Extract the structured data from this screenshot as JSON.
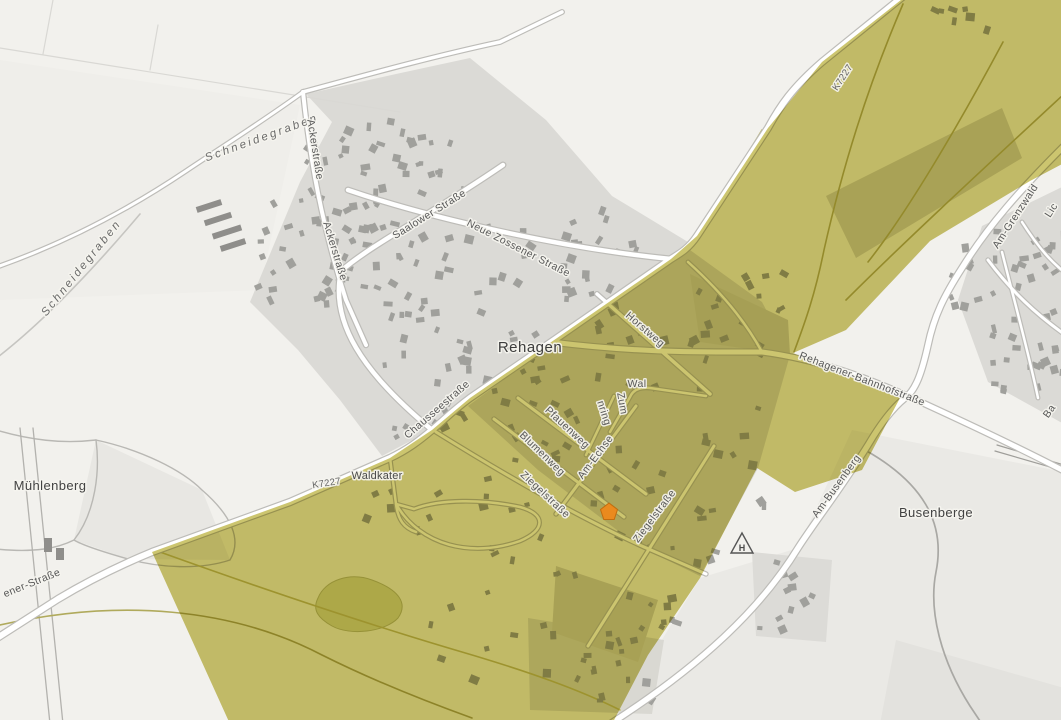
{
  "map": {
    "place_labels": [
      "Rehagen",
      "Mühlenberg",
      "Busenberge",
      "Waldkater"
    ],
    "labels": [
      {
        "text": "Schneidegraben",
        "x": 263,
        "y": 141,
        "rot": -20,
        "cls": "water"
      },
      {
        "text": "Schneidegraben",
        "x": 84,
        "y": 270,
        "rot": -51,
        "cls": "water"
      },
      {
        "text": "Ackerstraße",
        "x": 312,
        "y": 150,
        "rot": 81,
        "cls": "street"
      },
      {
        "text": "Ackerstraße",
        "x": 332,
        "y": 252,
        "rot": 73,
        "cls": "street"
      },
      {
        "text": "Saalower Straße",
        "x": 431,
        "y": 217,
        "rot": -32,
        "cls": "street"
      },
      {
        "text": "Neue Zossener Straße",
        "x": 517,
        "y": 251,
        "rot": 27,
        "cls": "street"
      },
      {
        "text": "Rehagen",
        "x": 530,
        "y": 352,
        "rot": 0,
        "cls": "place"
      },
      {
        "text": "Horstweg",
        "x": 643,
        "y": 332,
        "rot": 41,
        "cls": "street"
      },
      {
        "text": "Chausseestraße",
        "x": 439,
        "y": 412,
        "rot": -41,
        "cls": "street"
      },
      {
        "text": "Rehagener-Bahnhofstraße",
        "x": 861,
        "y": 382,
        "rot": 21,
        "cls": "street"
      },
      {
        "text": "K7227",
        "x": 845,
        "y": 79,
        "rot": -57,
        "cls": "ref"
      },
      {
        "text": "K7227",
        "x": 327,
        "y": 486,
        "rot": -9,
        "cls": "ref"
      },
      {
        "text": "Waldkater",
        "x": 377,
        "y": 479,
        "rot": 0,
        "cls": "locality"
      },
      {
        "text": "ener-Straße",
        "x": 33,
        "y": 586,
        "rot": -22,
        "cls": "street"
      },
      {
        "text": "Mühlenberg",
        "x": 50,
        "y": 490,
        "rot": 0,
        "cls": "place2"
      },
      {
        "text": "Ziegelstraße",
        "x": 543,
        "y": 497,
        "rot": 43,
        "cls": "street"
      },
      {
        "text": "Ziegelstraße",
        "x": 657,
        "y": 518,
        "rot": -53,
        "cls": "street"
      },
      {
        "text": "Blumenweg",
        "x": 540,
        "y": 456,
        "rot": 44,
        "cls": "street"
      },
      {
        "text": "Pfauenweg",
        "x": 565,
        "y": 430,
        "rot": 43,
        "cls": "street"
      },
      {
        "text": "Am-Echse",
        "x": 598,
        "y": 459,
        "rot": -53,
        "cls": "street"
      },
      {
        "text": "nring",
        "x": 601,
        "y": 414,
        "rot": 72,
        "cls": "street"
      },
      {
        "text": "Zum",
        "x": 619,
        "y": 404,
        "rot": 80,
        "cls": "street"
      },
      {
        "text": "Wal",
        "x": 637,
        "y": 387,
        "rot": 0,
        "cls": "street"
      },
      {
        "text": "Am-Busenberg",
        "x": 839,
        "y": 488,
        "rot": -54,
        "cls": "street"
      },
      {
        "text": "Busenberge",
        "x": 936,
        "y": 517,
        "rot": 0,
        "cls": "place2"
      },
      {
        "text": "Am-Grenzwald",
        "x": 1018,
        "y": 218,
        "rot": -57,
        "cls": "street"
      },
      {
        "text": "Lic",
        "x": 1054,
        "y": 212,
        "rot": -57,
        "cls": "street"
      },
      {
        "text": "Ba",
        "x": 1052,
        "y": 413,
        "rot": -55,
        "cls": "street"
      }
    ],
    "marker": {
      "x": 609,
      "y": 512,
      "color": "#ea8a1e",
      "border": "#c26d0e"
    },
    "hunting_stand": {
      "x": 742,
      "y": 545,
      "letter": "H"
    },
    "colors": {
      "overlay_olive": "#ccc56f",
      "field_white": "#f2f1ed",
      "residential_gray": "#dbdad6",
      "building_gray": "#a0a09c",
      "road_fill": "#ffffff",
      "road_casing": "#bdbcb8",
      "pond_green": "#d8daa6"
    }
  }
}
